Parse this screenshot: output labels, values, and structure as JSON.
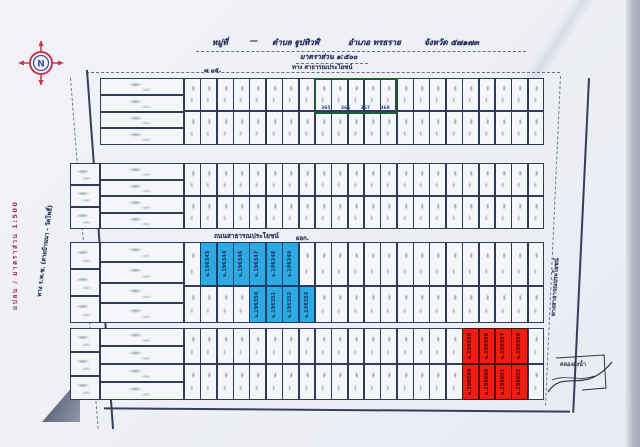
{
  "document": {
    "header": {
      "village_label": "หมู่ที่",
      "separator": "—",
      "subdistrict": "ตำบล ฐูปทิวฬ์",
      "district": "อำเภอ ทรธราย",
      "province": "จังหวัด ๕๗๑๗๓",
      "scale_note": "มาตราส่วน ๑:๕๐๐"
    },
    "side_labels": {
      "plan_scale_vertical": "แปลน / มาตราส่วน 1:500",
      "left_road": "ทาง ร.พ.ช. (สายบ้านนา - วัดโพธิ์)",
      "top_road": "ทาง สาธารณประโยชน์",
      "top_note": "๗ ๐๕.",
      "middle_road": "ถนนสาธารณประโยชน์",
      "middle_road_note": "ผอก.",
      "right_road": "ทางสาธารณประโยชน์",
      "bottom_sketch_label": "คลองส่งน้ำ"
    },
    "compass": {
      "direction": "N"
    }
  },
  "plat": {
    "bands": 4,
    "rows_per_band": 2,
    "columns": 22
  },
  "highlight_groups": [
    {
      "name": "blue",
      "fill": "#2ea9e1",
      "border": "#14406e",
      "text_color": "#0e3a63",
      "cells": [
        {
          "band": 2,
          "row": 0,
          "start_col": 1,
          "labels": [
            "ฉ.196343",
            "ฉ.196344",
            "ฉ.196346",
            "ฉ.196347",
            "ฉ.196348",
            "ฉ.196349"
          ]
        },
        {
          "band": 2,
          "row": 1,
          "start_col": 4,
          "labels": [
            "ฉ.196350",
            "ฉ.196351",
            "ฉ.196352",
            "ฉ.196353"
          ]
        }
      ]
    },
    {
      "name": "red",
      "fill": "#f21d12",
      "border": "#47100f",
      "text_color": "#38080a",
      "cells": [
        {
          "band": 3,
          "row": 0,
          "start_col": 17,
          "labels": [
            "ฉ.196595",
            "ฉ.196596",
            "ฉ.196597",
            "ฉ.196598"
          ]
        },
        {
          "band": 3,
          "row": 1,
          "start_col": 17,
          "labels": [
            "ฉ.196599",
            "ฉ.196600",
            "ฉ.196601",
            "ฉ.196602"
          ]
        }
      ]
    }
  ],
  "green_box": {
    "border_color": "#1d5b36",
    "plot_numbers": [
      "365",
      "366",
      "367",
      "368"
    ]
  }
}
